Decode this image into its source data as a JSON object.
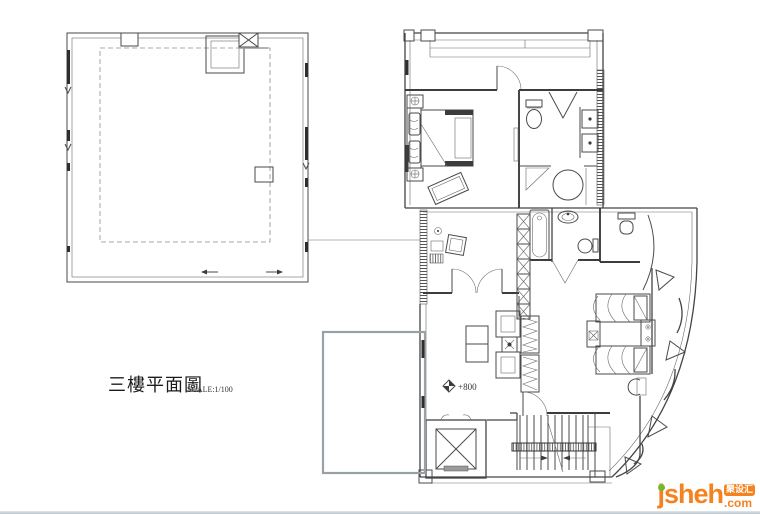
{
  "title_block": {
    "title": "三樓平面圖",
    "scale": "SCALE:1/100"
  },
  "annotations": {
    "level_marker": "+800"
  },
  "watermark": {
    "site": "jsheh",
    "tld": ".com",
    "badge": "聚设汇",
    "orange": "#f5821f",
    "green": "#76b82a",
    "badge_text_color": "#ffffff"
  },
  "colors": {
    "background": "#ffffff",
    "line": "#4a4a4a",
    "dark_marks": "#2e2e2e",
    "terrace_outline": "#9aa1a6",
    "bottom_edge": "#b9c4cb"
  },
  "plan": {
    "drawing_type": "floor-plan",
    "elements": [
      "large-roof-room",
      "skylight",
      "roof-hatch",
      "master-bedroom",
      "double-bed",
      "nightstands",
      "desk",
      "tv-panel",
      "bathroom-1",
      "toilet",
      "double-basin",
      "round-shower",
      "corner-shower",
      "bathroom-2",
      "bathtub",
      "oval-basin",
      "wc-toilet",
      "study-room",
      "french-doors",
      "wardrobe-x",
      "wardrobe-hangers",
      "family-room",
      "sofa-set",
      "side-table",
      "bedroom-2",
      "twin-beds",
      "nightstand",
      "stairs",
      "handrail",
      "elevator",
      "open-terrace",
      "curved-window-wall",
      "balcony-railing"
    ]
  }
}
